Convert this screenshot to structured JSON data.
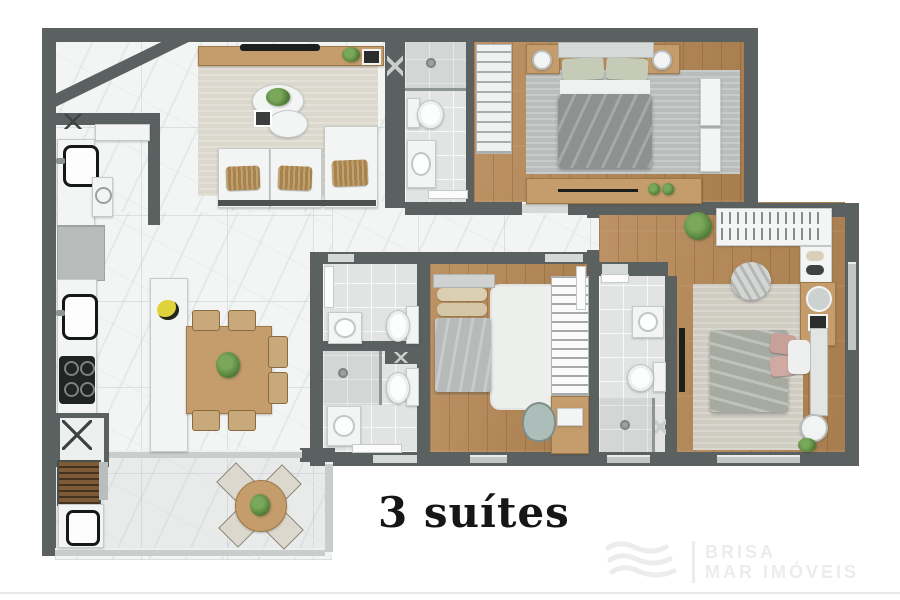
{
  "title": "3 suítes",
  "watermark": {
    "brand_line1": "BRISA",
    "brand_line2": "MAR IMÓVEIS",
    "logo": "waves-icon"
  },
  "colors": {
    "background": "#ffffff",
    "wall": "#5b6160",
    "marble_floor": "#f3f4f4",
    "wood_floor": "#b28757",
    "bath_tile": "#e1e4e3",
    "wood_furniture": "#c59c6c",
    "sofa_cushion": "#a9824a",
    "title_text": "#161616",
    "watermark_gray": "#ececec"
  }
}
